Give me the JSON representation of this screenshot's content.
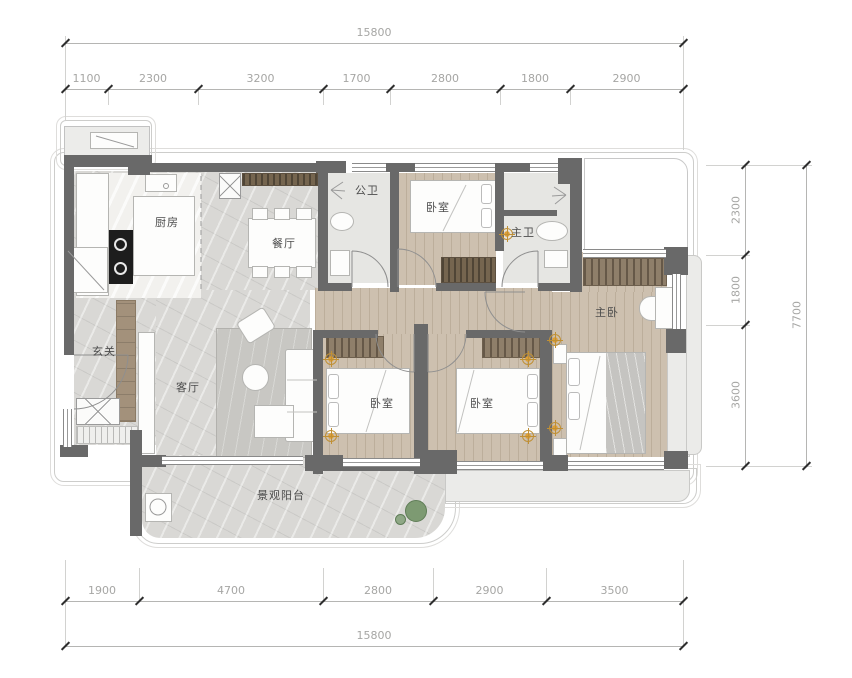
{
  "drawing": {
    "type": "apartment-floor-plan"
  },
  "dim_top": {
    "total": "15800",
    "segments": [
      "1100",
      "2300",
      "3200",
      "1700",
      "2800",
      "1800",
      "2900"
    ]
  },
  "dim_bottom": {
    "total": "15800",
    "segments": [
      "1900",
      "4700",
      "2800",
      "2900",
      "3500"
    ]
  },
  "dim_right": {
    "total": "7700",
    "segments": [
      "2300",
      "1800",
      "3600"
    ]
  },
  "rooms": {
    "kitchen": "厨房",
    "dining": "餐厅",
    "public_bath": "公卫",
    "bedroom_top": "卧室",
    "master_bath": "主卫",
    "master_bedroom": "主卧",
    "entry": "玄关",
    "living": "客厅",
    "bedroom_left": "卧室",
    "bedroom_right": "卧室",
    "balcony": "景观阳台"
  },
  "colors": {
    "wall": "#696969",
    "wood": "#cdc0af",
    "marble": "#d9d8d5",
    "tile": "#e6e6e3",
    "downlight": "#dd9f3c",
    "plant": "#7d9a72"
  }
}
